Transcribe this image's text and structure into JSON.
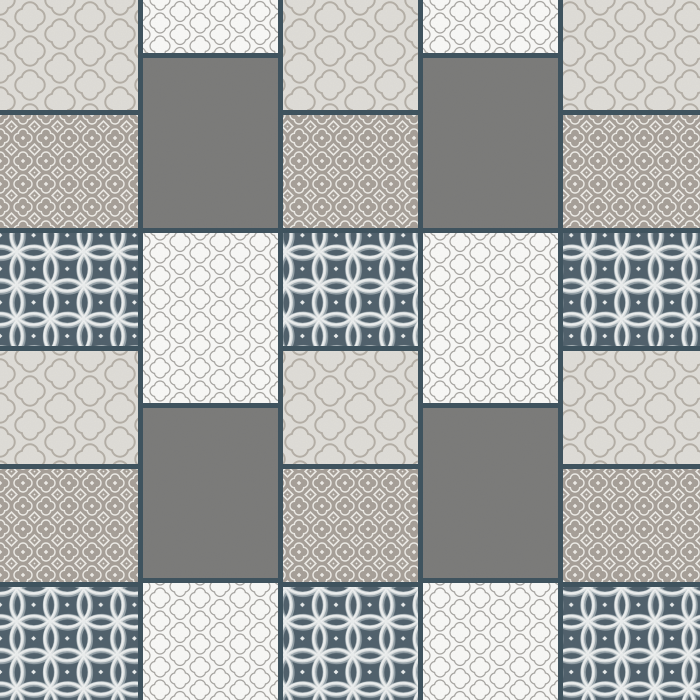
{
  "canvas": {
    "width": 700,
    "height": 700,
    "grout_color": "#3f535e"
  },
  "tile_types": {
    "A": {
      "label": "quatrefoil-trellis-light",
      "bg": "#e3e1db",
      "line": "#b7b1a8",
      "cell": {
        "w": 60,
        "h": 34
      },
      "lobe": 6.5,
      "r_out": 9.25,
      "r_in": 7.25,
      "noise": {
        "black": 0.06,
        "white": 0.05
      }
    },
    "B": {
      "label": "taupe-flower-dot",
      "bg": "#a9a29a",
      "line": "#f3f1ec",
      "cell": {
        "w": 23,
        "h": 23
      },
      "lobe": 4.3,
      "r_out": 5.4,
      "r_in": 4.0,
      "dot": 3.2,
      "diamond": 7.6,
      "noise": {
        "black": 0.07,
        "white": 0.06
      }
    },
    "C": {
      "label": "slate-circle-lattice",
      "bg": "#50616c",
      "cell": {
        "w": 33.6,
        "h": 33.6
      },
      "radius": 22.4,
      "stroke_shadow": "#94a1a8",
      "stroke_mid": "#dde2e3",
      "stroke_hi": "#f4f6f6",
      "dot_color": "#eef1f1",
      "dot": 3.4,
      "noise": {
        "black": 0.06,
        "white": 0.04
      }
    },
    "F": {
      "label": "quatrefoil-lattice-white",
      "bg": "#fbfbf9",
      "line": "#a9a7a3",
      "cell": {
        "w": 40,
        "h": 23
      },
      "lobe": 4.4,
      "r_out": 6.2,
      "r_in": 5.0,
      "noise": {
        "black": 0.04,
        "white": 0.03
      }
    },
    "G": {
      "label": "heather-gray-solid",
      "bg": "#7c7c7a",
      "noise": {
        "black": 0.3,
        "white": 0.24
      }
    }
  },
  "columns": [
    {
      "x": 0,
      "w": 138,
      "tiles": [
        [
          "A",
          0,
          110
        ],
        [
          "B",
          115,
          113
        ],
        [
          "C",
          233,
          113
        ],
        [
          "A",
          351,
          113
        ],
        [
          "B",
          469,
          113
        ],
        [
          "C",
          587,
          113
        ]
      ]
    },
    {
      "x": 143,
      "w": 135,
      "tiles": [
        [
          "F",
          0,
          53
        ],
        [
          "G",
          58,
          170
        ],
        [
          "F",
          233,
          170
        ],
        [
          "G",
          408,
          170
        ],
        [
          "F",
          583,
          117
        ]
      ]
    },
    {
      "x": 283,
      "w": 135,
      "tiles": [
        [
          "A",
          0,
          110
        ],
        [
          "B",
          115,
          113
        ],
        [
          "C",
          233,
          113
        ],
        [
          "A",
          351,
          113
        ],
        [
          "B",
          469,
          113
        ],
        [
          "C",
          587,
          113
        ]
      ]
    },
    {
      "x": 423,
      "w": 135,
      "tiles": [
        [
          "F",
          0,
          53
        ],
        [
          "G",
          58,
          170
        ],
        [
          "F",
          233,
          170
        ],
        [
          "G",
          408,
          170
        ],
        [
          "F",
          583,
          117
        ]
      ]
    },
    {
      "x": 563,
      "w": 137,
      "tiles": [
        [
          "A",
          0,
          110
        ],
        [
          "B",
          115,
          113
        ],
        [
          "C",
          233,
          113
        ],
        [
          "A",
          351,
          113
        ],
        [
          "B",
          469,
          113
        ],
        [
          "C",
          587,
          113
        ]
      ]
    }
  ]
}
